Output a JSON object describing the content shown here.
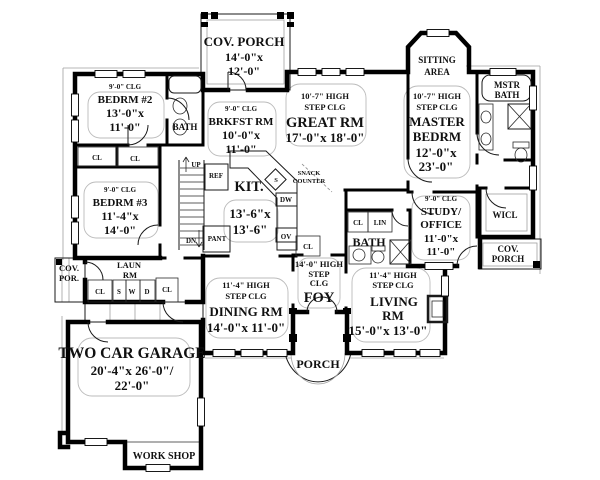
{
  "palette": {
    "ink": "#101010",
    "bg": "#ffffff",
    "thin_gray": "#a0a0a0"
  },
  "rooms": {
    "cov_porch_top": {
      "name": "COV. PORCH",
      "dims": [
        "14'-0\"x",
        "12'-0\""
      ]
    },
    "bedrm2": {
      "clg": "9'-0\" CLG",
      "name": "BEDRM #2",
      "dims": [
        "13'-0\"x",
        "11'-0\""
      ]
    },
    "bath_upper": {
      "name": "BATH"
    },
    "brkfst": {
      "clg": "9'-0\" CLG",
      "name": "BRKFST RM",
      "dims": [
        "10'-0\"x",
        "11'-0\""
      ]
    },
    "great": {
      "clg1": "10'-7\" HIGH",
      "clg2": "STEP CLG",
      "name": "GREAT RM",
      "dims": [
        "17'-0\"x 18'-0\""
      ]
    },
    "sitting": {
      "name1": "SITTING",
      "name2": "AREA"
    },
    "master": {
      "clg1": "10'-7\" HIGH",
      "clg2": "STEP CLG",
      "name1": "MASTER",
      "name2": "BEDRM",
      "dims": [
        "12'-0\"x",
        "23'-0\""
      ]
    },
    "mstr_bath": {
      "name1": "MSTR",
      "name2": "BATH"
    },
    "bedrm3": {
      "clg": "9'-0\" CLG",
      "name": "BEDRM #3",
      "dims": [
        "11'-4\"x",
        "14'-0\""
      ]
    },
    "kit": {
      "name": "KIT.",
      "dims": [
        "13'-6\"x",
        "13'-6\""
      ]
    },
    "snack": {
      "line1": "SNACK",
      "line2": "COUNTER"
    },
    "study": {
      "clg": "9'-0\" CLG",
      "name1": "STUDY/",
      "name2": "OFFICE",
      "dims": [
        "11'-0\"x",
        "11'-0\""
      ]
    },
    "wicl": {
      "name": "WICL"
    },
    "cov_porch_right": {
      "name1": "COV.",
      "name2": "PORCH"
    },
    "bath_center": {
      "name": "BATH"
    },
    "laun": {
      "name1": "LAUN",
      "name2": "RM"
    },
    "cov_por_left": {
      "name1": "COV.",
      "name2": "POR."
    },
    "dining": {
      "clg1": "11'-4\" HIGH",
      "clg2": "STEP CLG",
      "name": "DINING RM",
      "dims": [
        "14'-0\"x 11'-0\""
      ]
    },
    "foy": {
      "clg1": "14'-0\" HIGH",
      "clg2": "STEP",
      "clg3": "CLG",
      "name": "FOY"
    },
    "living": {
      "clg1": "11'-4\" HIGH",
      "clg2": "STEP CLG",
      "name1": "LIVING",
      "name2": "RM",
      "dims": [
        "15'-0\"x 13'-0\""
      ]
    },
    "garage": {
      "name": "TWO CAR GARAGE",
      "dims": [
        "20'-4\"x 26'-0\"/",
        "22'-0\""
      ]
    },
    "workshop": {
      "name": "WORK SHOP"
    },
    "porch": {
      "name": "PORCH"
    }
  },
  "labels": {
    "up": "UP",
    "dn": "DN",
    "ref": "REF",
    "pant": "PANT",
    "dw": "DW",
    "ov": "OV",
    "sink": "S",
    "cl": "CL",
    "lin": "LIN",
    "washer": "W",
    "dryer": "D",
    "laundry_sink": "S"
  }
}
